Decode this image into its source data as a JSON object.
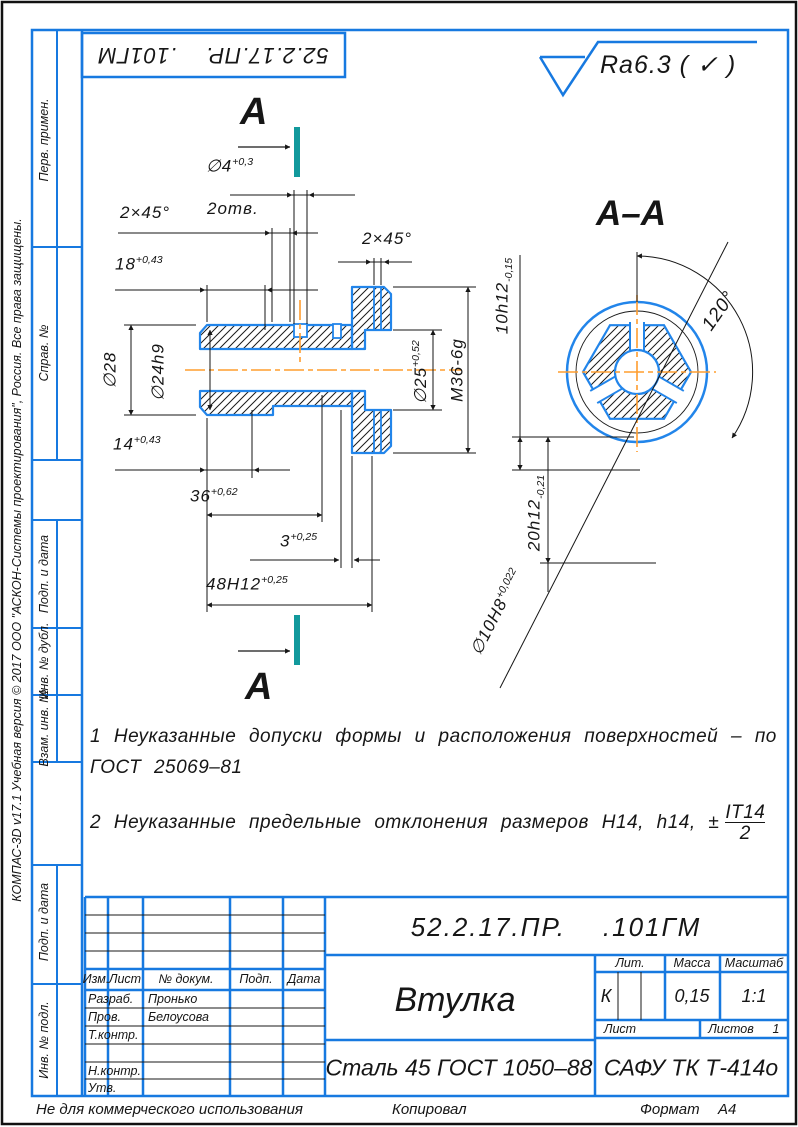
{
  "frame": {
    "surface_finish": "Ra6.3 ( ✓ )",
    "footer_left": "Не для коммерческого использования",
    "footer_center": "Копировал",
    "footer_format_label": "Формат",
    "footer_format_value": "А4",
    "copyright": "КОМПАС-3D v17.1 Учебная версия © 2017 ООО \"АСКОН-Системы проектирования\", Россия. Все права защищены."
  },
  "sidebar": {
    "cells": [
      "Перв. примен.",
      "Справ. №",
      "Подп. и дата",
      "Инв. № дубл.",
      "Взам. инв. №",
      "Подп. и дата",
      "Инв. № подл."
    ]
  },
  "views": {
    "cut_label_top": "А",
    "cut_label_bottom": "А",
    "section_title": "А–А"
  },
  "dims": {
    "phi4": {
      "v": "∅4",
      "t": "+0,3"
    },
    "holes": "2отв.",
    "chamfer_left": "2×45°",
    "len18": {
      "v": "18",
      "t": "+0,43"
    },
    "phi28": "∅28",
    "phi24": "∅24h9",
    "len14": {
      "v": "14",
      "t": "+0,43"
    },
    "len36": {
      "v": "36",
      "t": "+0,62"
    },
    "len3": {
      "v": "3",
      "t": "+0,25"
    },
    "len48": {
      "v": "48H12",
      "t": "+0,25"
    },
    "chamfer_right": "2×45°",
    "phi25": {
      "v": "∅25",
      "t": "+0,52"
    },
    "thread": "M36-6g",
    "w10": {
      "v": "10h12",
      "t": "-0,15"
    },
    "w20": {
      "v": "20h12",
      "t": "-0,21"
    },
    "phi10": {
      "v": "∅10H8",
      "t": "+0,022"
    },
    "angle": "120°"
  },
  "notes": {
    "line1": "1 Неуказанные допуски формы и расположения поверхностей – по",
    "line2": "ГОСТ 25069–81",
    "line3": "2 Неуказанные предельные отклонения размеров H14, h14, ±",
    "frac_num": "IT14",
    "frac_den": "2"
  },
  "titleblock": {
    "doc_number": "52.2.17.ПР.    .101ГМ",
    "part_name": "Втулка",
    "material": "Сталь 45 ГОСТ 1050–88",
    "organization": "САФУ ТК Т-414о",
    "lit_header": "Лит.",
    "mass_header": "Масса",
    "scale_header": "Масштаб",
    "lit_value": "К",
    "mass_value": "0,15",
    "scale_value": "1:1",
    "sheet_label": "Лист",
    "sheets_label": "Листов",
    "sheets_value": "1",
    "cols": {
      "izm": "Изм.",
      "list": "Лист",
      "doc": "№ докум.",
      "podp": "Подп.",
      "data": "Дата"
    },
    "rows": [
      {
        "role": "Разраб.",
        "name": "Пронько"
      },
      {
        "role": "Пров.",
        "name": "Белоусова"
      },
      {
        "role": "Т.контр.",
        "name": ""
      },
      {
        "role": "",
        "name": ""
      },
      {
        "role": "Н.контр.",
        "name": ""
      },
      {
        "role": "Утв.",
        "name": ""
      }
    ]
  }
}
